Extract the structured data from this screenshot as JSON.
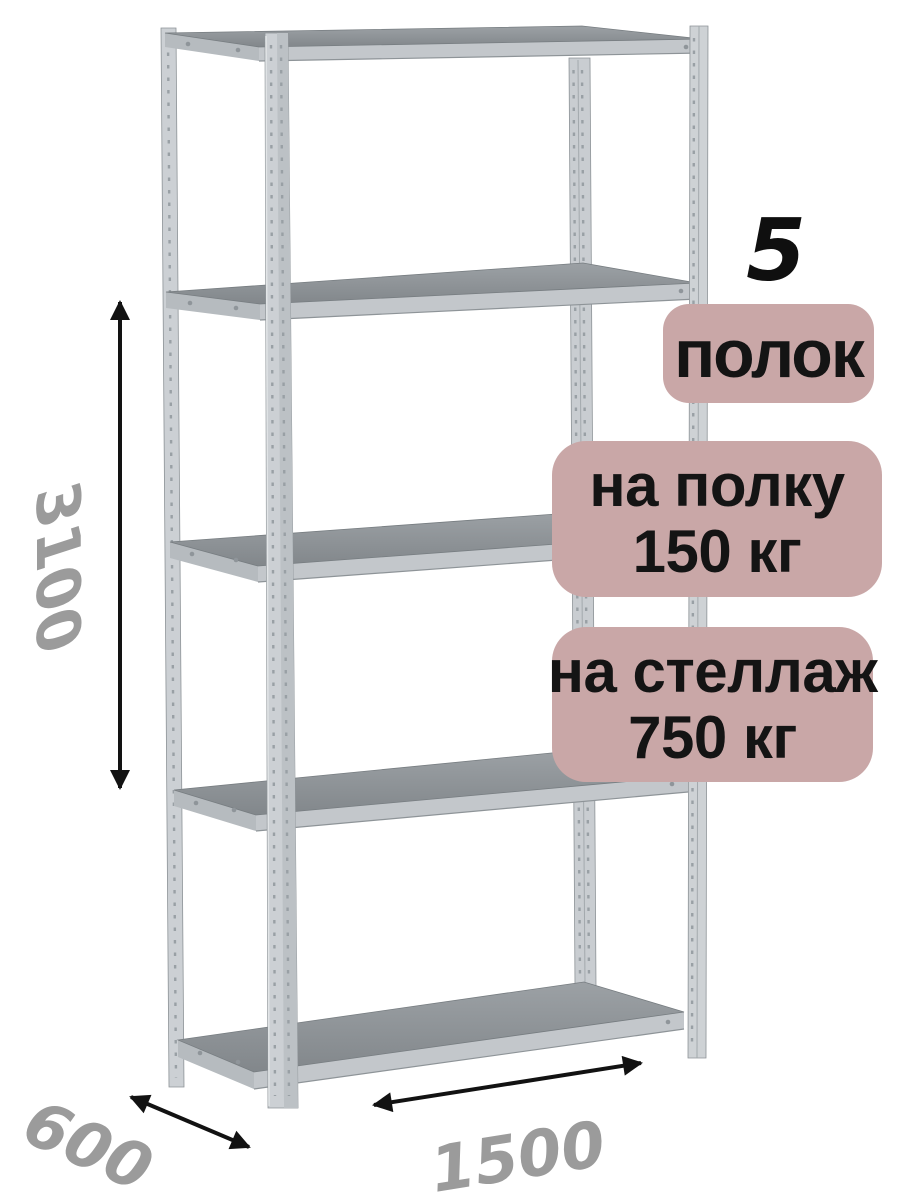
{
  "badges": {
    "count_number": "5",
    "count_label": "полок",
    "shelf_load_line1": "на полку",
    "shelf_load_line2": "150 кг",
    "rack_load_line1": "на стеллаж",
    "rack_load_line2": "750 кг"
  },
  "dimensions": {
    "height": "3100",
    "depth": "600",
    "width": "1500"
  },
  "colors": {
    "background": "#ffffff",
    "badge_bg": "#c9a7a7",
    "badge_text": "#141414",
    "dimension_text": "#9b9b9b",
    "arrow": "#121212",
    "metal_light": "#cdd1d5",
    "metal_beam": "#c3c7cb",
    "shelf_surface": "#8b9094"
  }
}
